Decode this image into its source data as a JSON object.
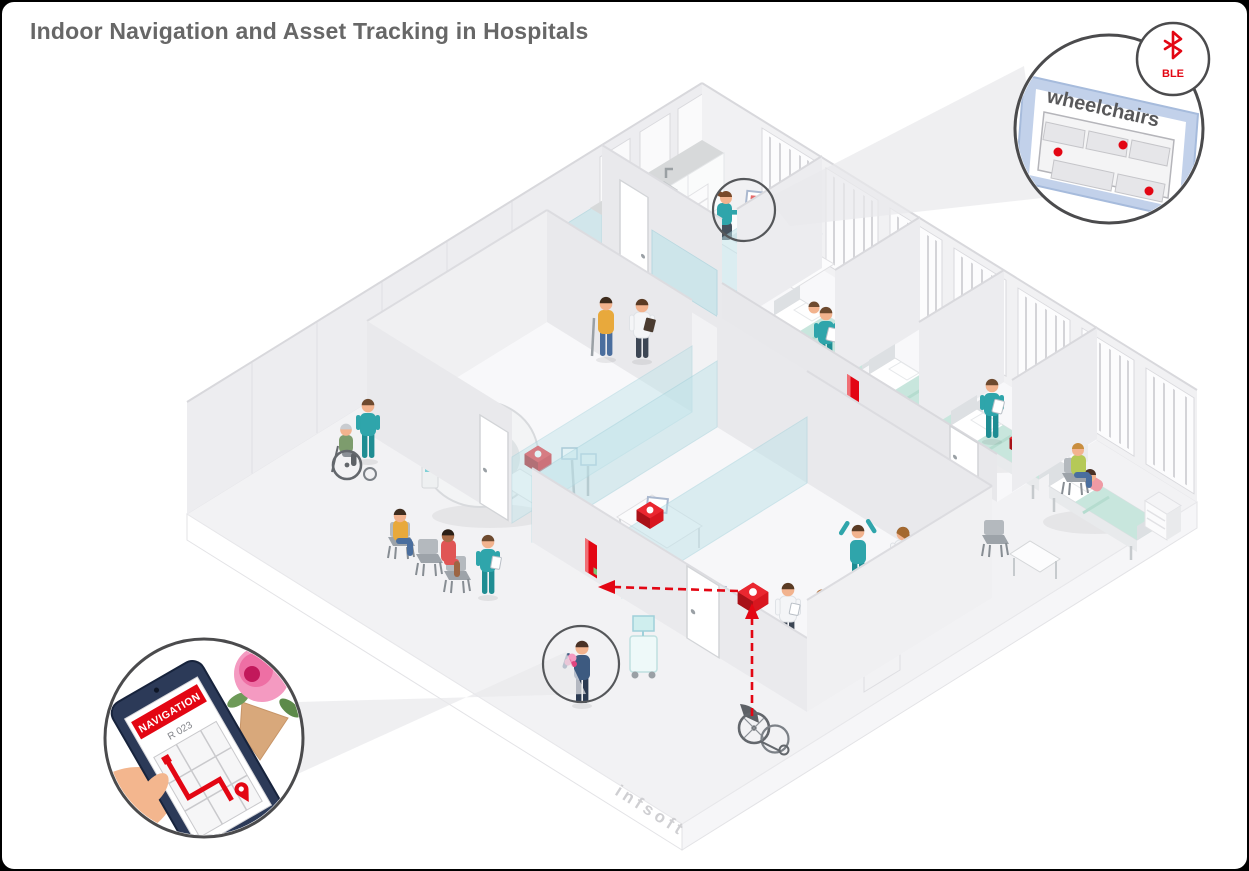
{
  "title": "Indoor Navigation and Asset Tracking in Hospitals",
  "brand": {
    "watermark": "infsoft"
  },
  "callouts": {
    "asset_screen": {
      "label": "wheelchairs",
      "badge": "BLE",
      "tracked_asset_dots": 3
    },
    "phone": {
      "banner": "NAVIGATION",
      "room": "R 023"
    }
  },
  "colors": {
    "accent_red": "#e30613",
    "scrubs_teal": "#2fa5ab",
    "blanket_mint": "#c8e6dd",
    "glass_teal": "#bfe3e9",
    "wall_gray": "#ededf0",
    "floor_gray": "#f2f2f4",
    "title_gray": "#676767"
  },
  "icons": {
    "bluetooth_icon": "Bluetooth low energy symbol",
    "location_pin_icon": "map pin on navigation route",
    "beacon_icon": "red BLE beacon box"
  }
}
